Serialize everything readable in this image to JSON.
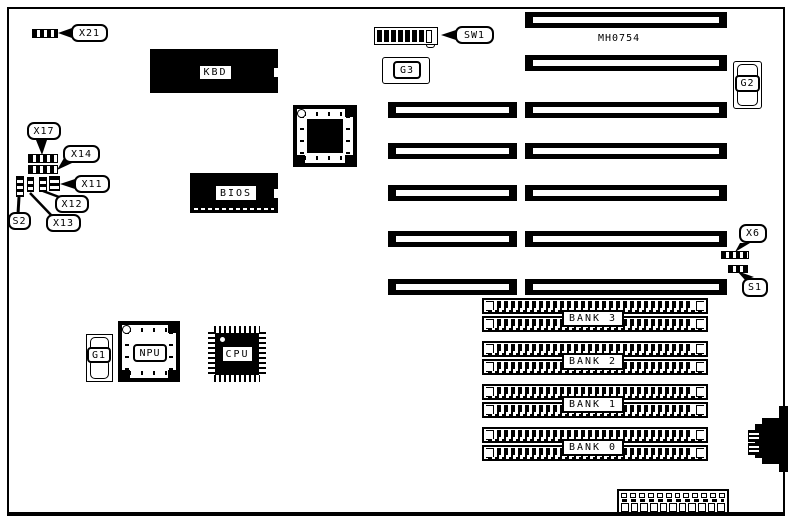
{
  "diagram": {
    "model_text": "MH0754",
    "callouts": {
      "x21": "X21",
      "x17": "X17",
      "x14": "X14",
      "x11": "X11",
      "x12": "X12",
      "x13": "X13",
      "s2": "S2",
      "sw1": "SW1",
      "x6": "X6",
      "s1": "S1"
    },
    "chips": {
      "kbd": "KBD",
      "bios": "BIOS",
      "npu": "NPU",
      "cpu": "CPU"
    },
    "sockets": {
      "g1": "G1",
      "g2": "G2",
      "g3": "G3"
    },
    "memory_banks": [
      {
        "label": "BANK 3"
      },
      {
        "label": "BANK 2"
      },
      {
        "label": "BANK 1"
      },
      {
        "label": "BANK 0"
      }
    ],
    "colors": {
      "ink": "#000000",
      "paper": "#ffffff"
    }
  }
}
